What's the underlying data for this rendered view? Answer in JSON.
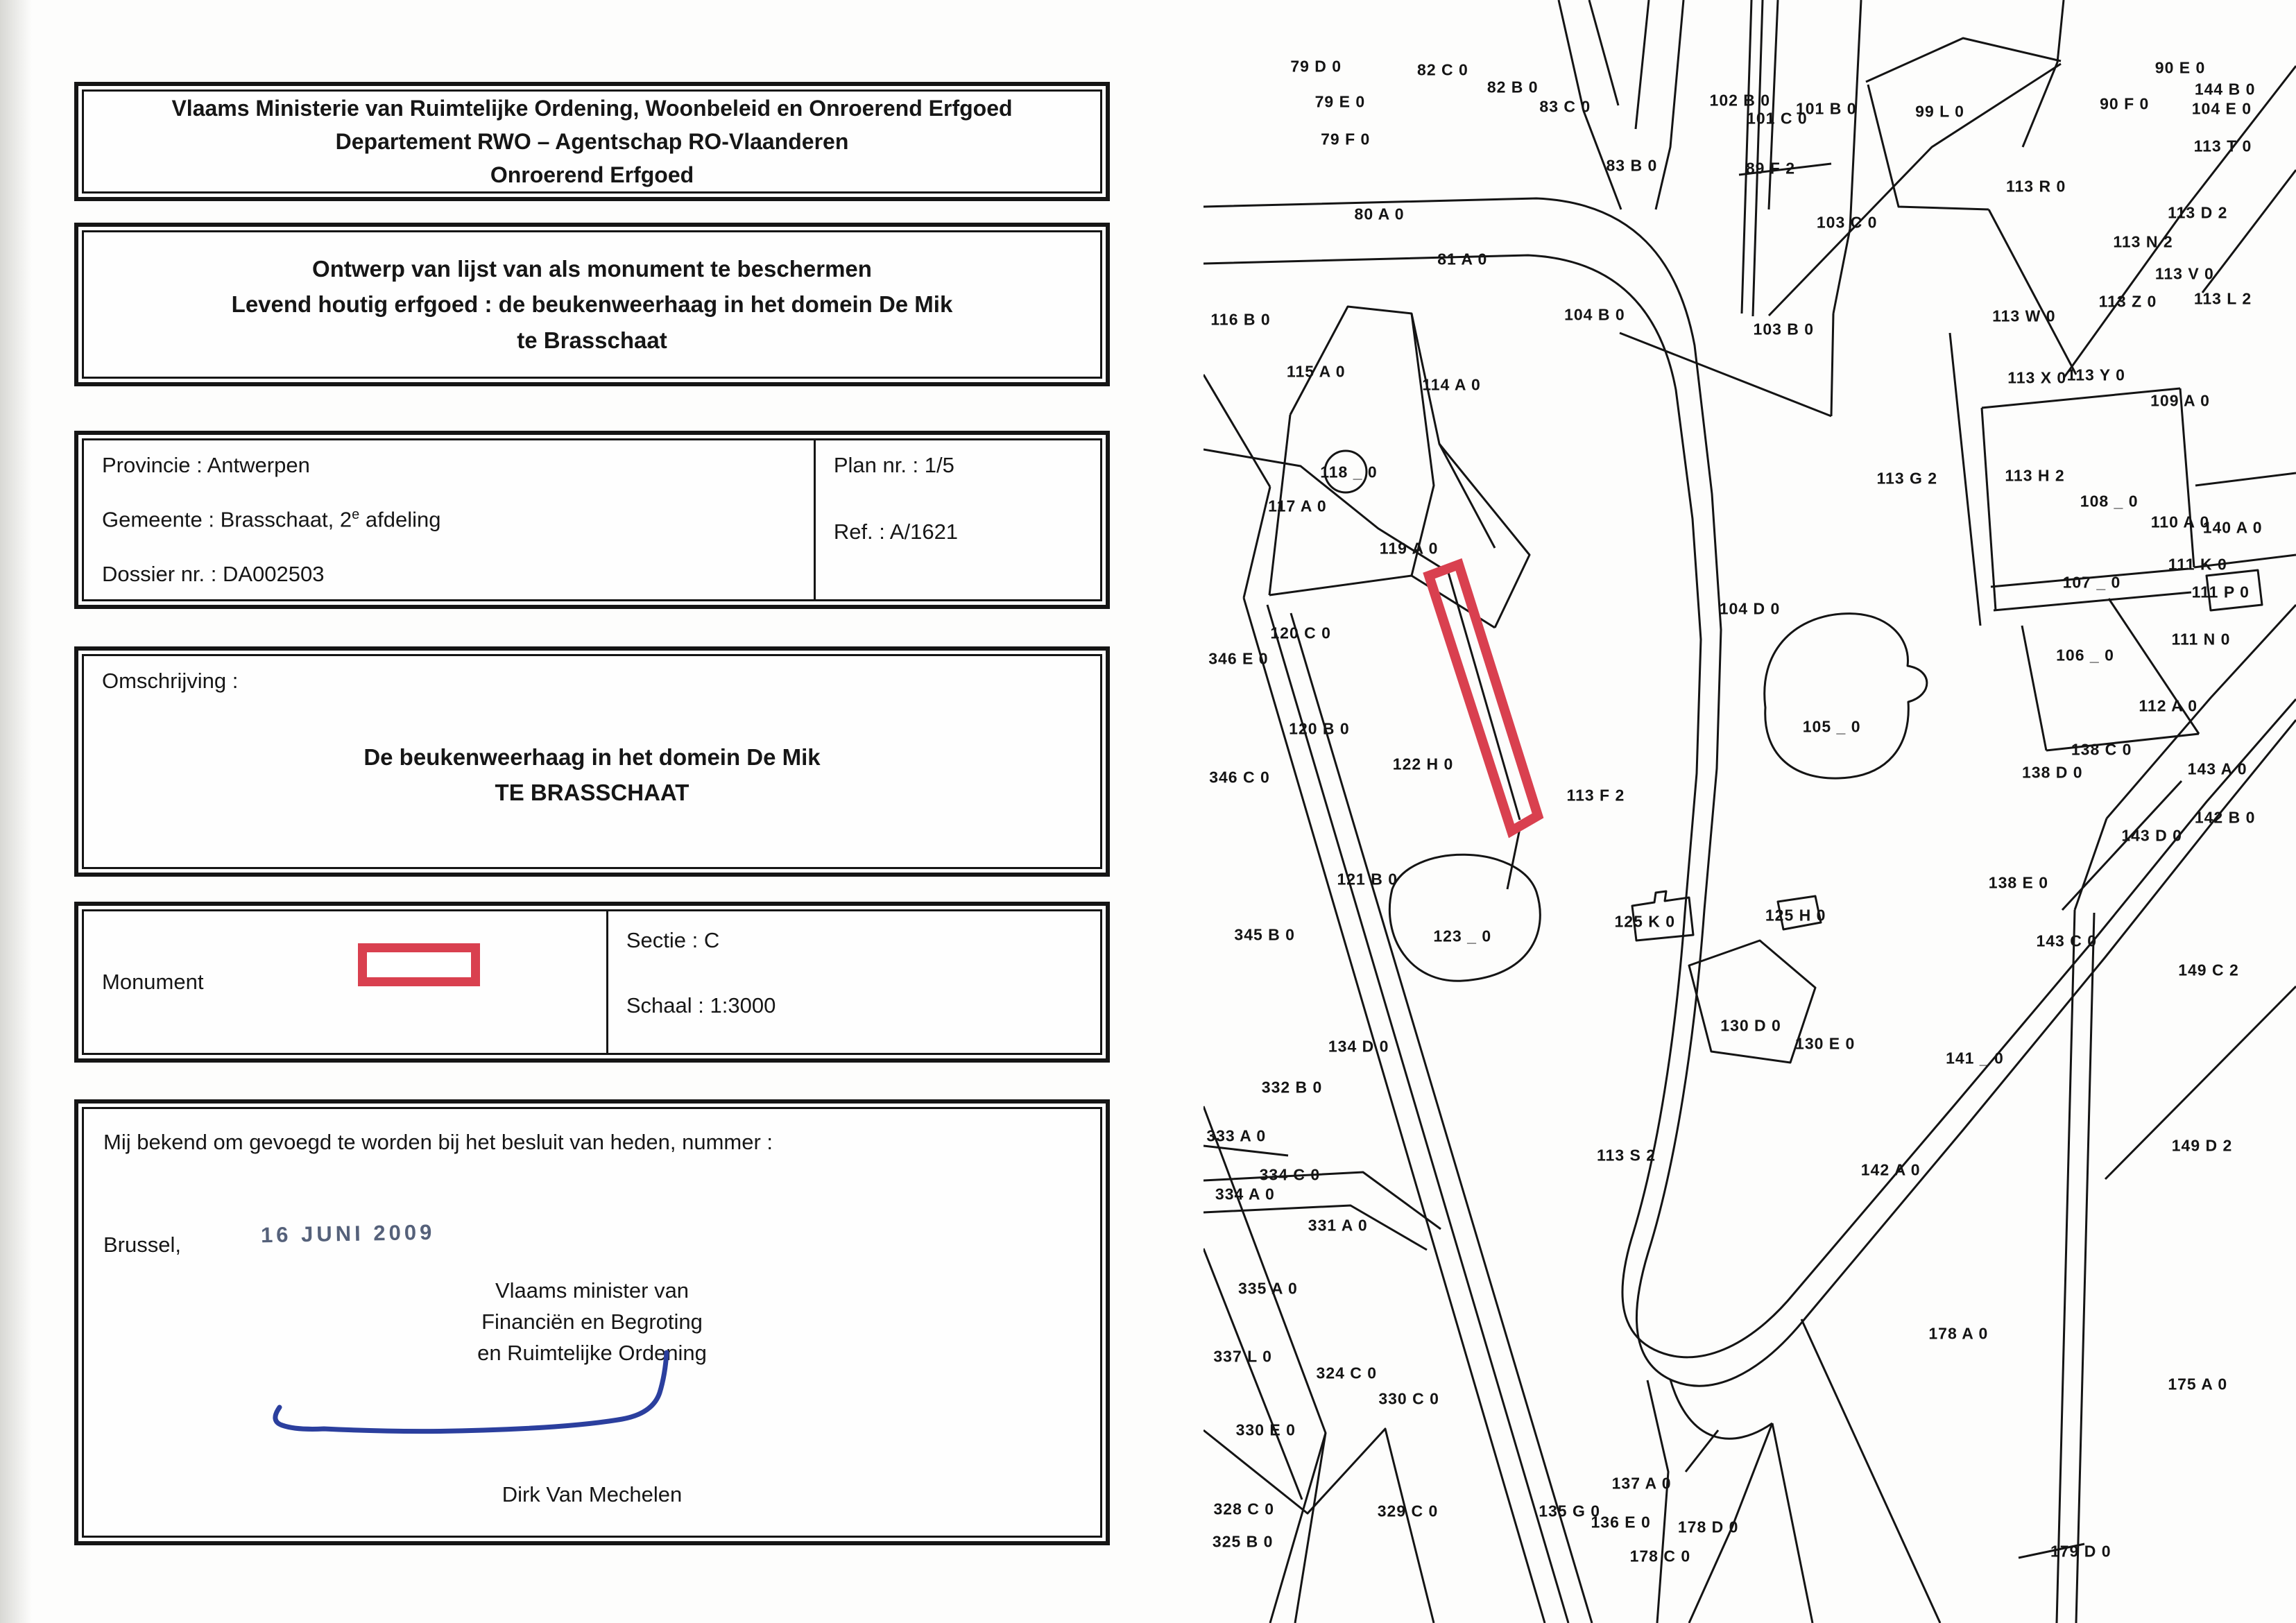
{
  "document": {
    "header": {
      "line1": "Vlaams Ministerie van Ruimtelijke Ordening, Woonbeleid en Onroerend Erfgoed",
      "line2": "Departement RWO – Agentschap RO-Vlaanderen",
      "line3": "Onroerend Erfgoed"
    },
    "title": {
      "line1": "Ontwerp van lijst van als monument te beschermen",
      "line2": "Levend houtig erfgoed : de beukenweerhaag in het domein De Mik",
      "line3": "te Brasschaat"
    },
    "info": {
      "provincie": "Provincie : Antwerpen",
      "gemeente_prefix": "Gemeente : Brasschaat, 2",
      "gemeente_sup": "e",
      "gemeente_suffix": " afdeling",
      "dossier": "Dossier nr. : DA002503",
      "plan": "Plan nr. : 1/5",
      "ref": "Ref. : A/1621"
    },
    "omschrijving": {
      "label": "Omschrijving :",
      "line1": "De beukenweerhaag in het domein De Mik",
      "line2": "TE BRASSCHAAT"
    },
    "legend": {
      "monument_label": "Monument",
      "sectie": "Sectie : C",
      "schaal": "Schaal : 1:3000"
    },
    "closing": {
      "line": "Mij bekend om gevoegd te worden bij het besluit van heden, nummer :",
      "city": "Brussel,",
      "date_stamp": "16 JUNI 2009",
      "minister_line1": "Vlaams minister van",
      "minister_line2": "Financiën en Begroting",
      "minister_line3": "en Ruimtelijke Ordening",
      "signatory": "Dirk Van Mechelen"
    }
  },
  "map": {
    "highlight_color": "#d9404f",
    "line_color": "#141414",
    "parcels": [
      {
        "t": "79 D 0",
        "x": 10.3,
        "y": 4.1
      },
      {
        "t": "82 C 0",
        "x": 21.9,
        "y": 4.3
      },
      {
        "t": "82 B 0",
        "x": 28.3,
        "y": 5.4
      },
      {
        "t": "79 E 0",
        "x": 12.5,
        "y": 6.3
      },
      {
        "t": "83 C 0",
        "x": 33.1,
        "y": 6.6
      },
      {
        "t": "102 B 0",
        "x": 49.1,
        "y": 6.2
      },
      {
        "t": "101 C 0",
        "x": 52.5,
        "y": 7.3
      },
      {
        "t": "101 B 0",
        "x": 57.0,
        "y": 6.7
      },
      {
        "t": "99 L 0",
        "x": 67.4,
        "y": 6.9
      },
      {
        "t": "90 E 0",
        "x": 89.4,
        "y": 4.2
      },
      {
        "t": "90 F 0",
        "x": 84.3,
        "y": 6.4
      },
      {
        "t": "144 B 0",
        "x": 93.5,
        "y": 5.5
      },
      {
        "t": "104 E 0",
        "x": 93.2,
        "y": 6.7
      },
      {
        "t": "113 T 0",
        "x": 93.3,
        "y": 9.0
      },
      {
        "t": "79 F 0",
        "x": 13.0,
        "y": 8.6
      },
      {
        "t": "83 B 0",
        "x": 39.2,
        "y": 10.2
      },
      {
        "t": "89 F 2",
        "x": 51.9,
        "y": 10.4
      },
      {
        "t": "113 R 0",
        "x": 76.2,
        "y": 11.5
      },
      {
        "t": "80 A 0",
        "x": 16.1,
        "y": 13.2
      },
      {
        "t": "103 C 0",
        "x": 58.9,
        "y": 13.7
      },
      {
        "t": "113 D 2",
        "x": 91.0,
        "y": 13.1
      },
      {
        "t": "113 N 2",
        "x": 86.0,
        "y": 14.9
      },
      {
        "t": "81 A 0",
        "x": 23.7,
        "y": 16.0
      },
      {
        "t": "113 V 0",
        "x": 89.8,
        "y": 16.9
      },
      {
        "t": "113 Z 0",
        "x": 84.6,
        "y": 18.6
      },
      {
        "t": "113 L 2",
        "x": 93.3,
        "y": 18.4
      },
      {
        "t": "104 B 0",
        "x": 35.8,
        "y": 19.4
      },
      {
        "t": "116 B 0",
        "x": 3.4,
        "y": 19.7
      },
      {
        "t": "113 W 0",
        "x": 75.1,
        "y": 19.5
      },
      {
        "t": "103 B 0",
        "x": 53.1,
        "y": 20.3
      },
      {
        "t": "113 X 0",
        "x": 76.3,
        "y": 23.3
      },
      {
        "t": "113 Y 0",
        "x": 81.7,
        "y": 23.1
      },
      {
        "t": "115 A 0",
        "x": 10.3,
        "y": 22.9
      },
      {
        "t": "114 A 0",
        "x": 22.7,
        "y": 23.7
      },
      {
        "t": "109 A 0",
        "x": 89.4,
        "y": 24.7
      },
      {
        "t": "118 _ 0",
        "x": 13.3,
        "y": 29.1
      },
      {
        "t": "113 G 2",
        "x": 64.4,
        "y": 29.5
      },
      {
        "t": "113 H 2",
        "x": 76.1,
        "y": 29.3
      },
      {
        "t": "108 _ 0",
        "x": 82.9,
        "y": 30.9
      },
      {
        "t": "117 A 0",
        "x": 8.6,
        "y": 31.2
      },
      {
        "t": "110 A 0",
        "x": 89.4,
        "y": 32.2
      },
      {
        "t": "140 A 0",
        "x": 94.2,
        "y": 32.5
      },
      {
        "t": "119 A 0",
        "x": 18.8,
        "y": 33.8
      },
      {
        "t": "111 K 0",
        "x": 91.0,
        "y": 34.8
      },
      {
        "t": "107 _ 0",
        "x": 81.3,
        "y": 35.9
      },
      {
        "t": "111 P 0",
        "x": 93.1,
        "y": 36.5
      },
      {
        "t": "104 D 0",
        "x": 50.0,
        "y": 37.5
      },
      {
        "t": "120 C 0",
        "x": 8.9,
        "y": 39.0
      },
      {
        "t": "346 E 0",
        "x": 3.2,
        "y": 40.6
      },
      {
        "t": "111 N 0",
        "x": 91.3,
        "y": 39.4
      },
      {
        "t": "106 _ 0",
        "x": 80.7,
        "y": 40.4
      },
      {
        "t": "120 B 0",
        "x": 10.6,
        "y": 44.9
      },
      {
        "t": "105 _ 0",
        "x": 57.5,
        "y": 44.8
      },
      {
        "t": "112 A 0",
        "x": 88.3,
        "y": 43.5
      },
      {
        "t": "122 H 0",
        "x": 20.1,
        "y": 47.1
      },
      {
        "t": "113 F 2",
        "x": 35.9,
        "y": 49.0
      },
      {
        "t": "138 C 0",
        "x": 82.2,
        "y": 46.2
      },
      {
        "t": "138 D 0",
        "x": 77.7,
        "y": 47.6
      },
      {
        "t": "143 A 0",
        "x": 92.8,
        "y": 47.4
      },
      {
        "t": "346 C 0",
        "x": 3.3,
        "y": 47.9
      },
      {
        "t": "142 B 0",
        "x": 93.5,
        "y": 50.4
      },
      {
        "t": "143 D 0",
        "x": 86.8,
        "y": 51.5
      },
      {
        "t": "121 B 0",
        "x": 15.0,
        "y": 54.2
      },
      {
        "t": "138 E 0",
        "x": 74.6,
        "y": 54.4
      },
      {
        "t": "125 K 0",
        "x": 40.4,
        "y": 56.8
      },
      {
        "t": "125 H 0",
        "x": 54.2,
        "y": 56.4
      },
      {
        "t": "345 B 0",
        "x": 5.6,
        "y": 57.6
      },
      {
        "t": "123 _ 0",
        "x": 23.7,
        "y": 57.7
      },
      {
        "t": "143 C 0",
        "x": 79.0,
        "y": 58.0
      },
      {
        "t": "149 C 2",
        "x": 92.0,
        "y": 59.8
      },
      {
        "t": "130 D 0",
        "x": 50.1,
        "y": 63.2
      },
      {
        "t": "130 E 0",
        "x": 56.9,
        "y": 64.3
      },
      {
        "t": "134 D 0",
        "x": 14.2,
        "y": 64.5
      },
      {
        "t": "141 _ 0",
        "x": 70.6,
        "y": 65.2
      },
      {
        "t": "332 B 0",
        "x": 8.1,
        "y": 67.0
      },
      {
        "t": "113 S 2",
        "x": 38.7,
        "y": 71.2
      },
      {
        "t": "142 A 0",
        "x": 62.9,
        "y": 72.1
      },
      {
        "t": "149 D 2",
        "x": 91.4,
        "y": 70.6
      },
      {
        "t": "333 A 0",
        "x": 3.0,
        "y": 70.0
      },
      {
        "t": "334 C 0",
        "x": 7.9,
        "y": 72.4
      },
      {
        "t": "334 A 0",
        "x": 3.8,
        "y": 73.6
      },
      {
        "t": "331 A 0",
        "x": 12.3,
        "y": 75.5
      },
      {
        "t": "335 A 0",
        "x": 5.9,
        "y": 79.4
      },
      {
        "t": "178 A 0",
        "x": 69.1,
        "y": 82.2
      },
      {
        "t": "337 L 0",
        "x": 3.6,
        "y": 83.6
      },
      {
        "t": "324 C 0",
        "x": 13.1,
        "y": 84.6
      },
      {
        "t": "175 A 0",
        "x": 91.0,
        "y": 85.3
      },
      {
        "t": "330 C 0",
        "x": 18.8,
        "y": 86.2
      },
      {
        "t": "330 E 0",
        "x": 5.7,
        "y": 88.1
      },
      {
        "t": "328 C 0",
        "x": 3.7,
        "y": 93.0
      },
      {
        "t": "325 B 0",
        "x": 3.6,
        "y": 95.0
      },
      {
        "t": "329 C 0",
        "x": 18.7,
        "y": 93.1
      },
      {
        "t": "135 G 0",
        "x": 33.5,
        "y": 93.1
      },
      {
        "t": "137 A 0",
        "x": 40.1,
        "y": 91.4
      },
      {
        "t": "136 E 0",
        "x": 38.2,
        "y": 93.8
      },
      {
        "t": "178 D 0",
        "x": 46.2,
        "y": 94.1
      },
      {
        "t": "178 C 0",
        "x": 41.8,
        "y": 95.9
      },
      {
        "t": "179 D 0",
        "x": 80.3,
        "y": 95.6
      }
    ]
  }
}
